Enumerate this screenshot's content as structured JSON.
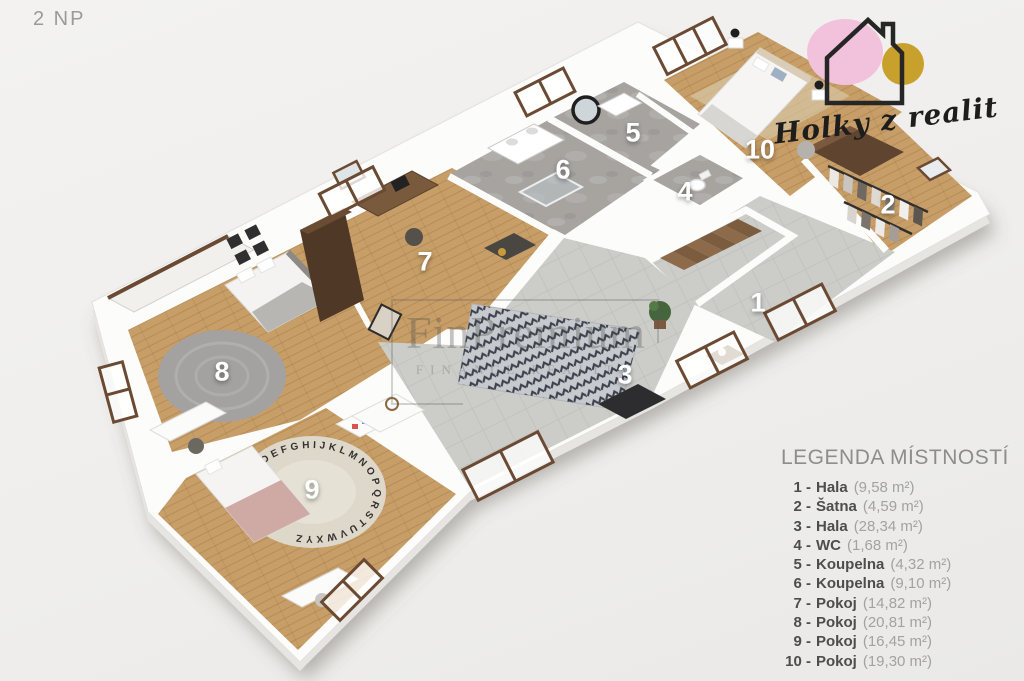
{
  "header": {
    "floor_label": "2 NP"
  },
  "logo": {
    "text": "Holky z realit",
    "pink": "#f2c2dc",
    "gold": "#c8a02c",
    "outline": "#262626"
  },
  "watermark": {
    "title": "FinPremium",
    "subtitle": "FINANCE REALITY"
  },
  "legend": {
    "title": "LEGENDA MÍSTNOSTÍ",
    "rooms": [
      {
        "num_label": "1 -",
        "name": "Hala",
        "area": "(9,58 m²)"
      },
      {
        "num_label": "2 -",
        "name": "Šatna",
        "area": "(4,59 m²)"
      },
      {
        "num_label": "3 -",
        "name": "Hala",
        "area": "(28,34 m²)"
      },
      {
        "num_label": "4 -",
        "name": "WC",
        "area": "(1,68 m²)"
      },
      {
        "num_label": "5 -",
        "name": "Koupelna",
        "area": "(4,32 m²)"
      },
      {
        "num_label": "6 -",
        "name": "Koupelna",
        "area": "(9,10 m²)"
      },
      {
        "num_label": "7 -",
        "name": "Pokoj",
        "area": "(14,82 m²)"
      },
      {
        "num_label": "8 -",
        "name": "Pokoj",
        "area": "(20,81 m²)"
      },
      {
        "num_label": "9 -",
        "name": "Pokoj",
        "area": "(16,45 m²)"
      },
      {
        "num_label": "10 -",
        "name": "Pokoj",
        "area": "(19,30 m²)"
      }
    ]
  },
  "plan": {
    "markers": [
      {
        "num": "1",
        "x": 758,
        "y": 303
      },
      {
        "num": "2",
        "x": 888,
        "y": 205
      },
      {
        "num": "3",
        "x": 625,
        "y": 375
      },
      {
        "num": "4",
        "x": 685,
        "y": 192
      },
      {
        "num": "5",
        "x": 633,
        "y": 133
      },
      {
        "num": "6",
        "x": 563,
        "y": 170
      },
      {
        "num": "7",
        "x": 425,
        "y": 262
      },
      {
        "num": "8",
        "x": 222,
        "y": 372
      },
      {
        "num": "9",
        "x": 312,
        "y": 490
      },
      {
        "num": "10",
        "x": 760,
        "y": 150
      }
    ],
    "rug_letters": "ABCDEFGHIJKLMNOPQRSTUVWXYZ"
  }
}
